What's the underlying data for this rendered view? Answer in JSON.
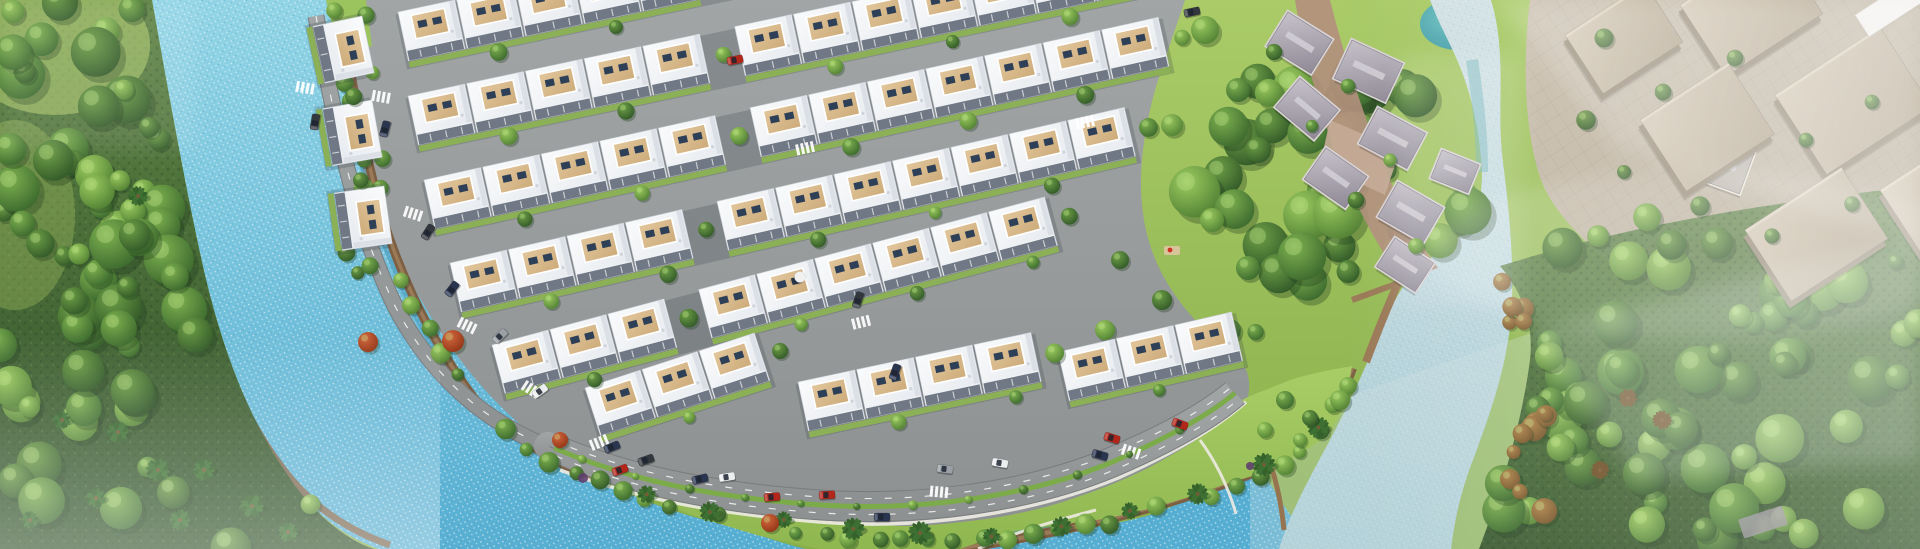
{
  "meta": {
    "title": "Aerial masterplan render — riverside townhouse estate",
    "type": "architectural-aerial-render",
    "width": 1920,
    "height": 549
  },
  "palette": {
    "lawn_hi": "#aacb68",
    "lawn_lo": "#88af4a",
    "lawn2_hi": "#a9cd66",
    "lawn2_lo": "#8fb750",
    "water_hi": "#93d5e6",
    "water_lo": "#56aed2",
    "water_deep": "#3a8cb0",
    "sparkle": "#eafafc",
    "pale_hi": "#d3e2e4",
    "pale_lo": "#a8ccd6",
    "pond_hi": "#6fc2c0",
    "pond_lo": "#3d96a4",
    "forest_hi": "#5d8243",
    "forest_lo": "#33532c",
    "road": "#949798",
    "road_dark": "#797c7e",
    "lane_white": "#ffffff",
    "trail": "#84603f",
    "trail_hi": "#9b7a58",
    "trail_dark": "#503b27",
    "house_hi": "#fafbfc",
    "house_lo": "#e4e8ed",
    "house_side": "#d7dce2",
    "facade": "#6f7884",
    "parapet": "#eef1f4",
    "roof_hi": "#e2c79c",
    "roof_lo": "#cdab7a",
    "window": "#2e4057",
    "median": "#7cab4a",
    "garden": "#8bb055",
    "path_white": "#edeae2",
    "tree_a_hi": "#9ccb60",
    "tree_a_lo": "#49782f",
    "tree_b_hi": "#7fb250",
    "tree_b_lo": "#34612a",
    "tree_c_hi": "#6fa047",
    "tree_c_lo": "#2b5125",
    "red_hi": "#d2683e",
    "red_lo": "#8c3012",
    "brown_hi": "#b08448",
    "brown_lo": "#6f4f26",
    "palm": "#35612b",
    "palm2": "#3d7032",
    "palm_trunk": "#7a5a36",
    "vroof_hi": "#c6c1c9",
    "vroof_lo": "#8f8a96",
    "vwall": "#d9d3d6",
    "vground": "#b28f7d",
    "vplaza": "#c5ab97",
    "beige_hi": "#d3c7b3",
    "beige_lo": "#b1a38c",
    "beige_side": "#978a76",
    "plaza_hi": "#cbc0af",
    "plaza_lo": "#b5aa96",
    "cream_wall": "#ece4d2",
    "cream_roof": "#b9b2a8",
    "car_red": "#b3261a",
    "car_navy": "#2a3550",
    "car_gray": "#9aa0a6",
    "car_white": "#eceef0",
    "car_dark": "#33383f",
    "shrub_purple": "#5e3f6e",
    "haze": "#ffffff"
  },
  "estate": {
    "unit": {
      "w": 60,
      "d": 50,
      "roof_w": 34,
      "roof_d": 24,
      "gap": 34
    },
    "rows": [
      {
        "x": 398,
        "y": 12,
        "a": -12,
        "segs": [
          5,
          7
        ]
      },
      {
        "x": 408,
        "y": 96,
        "a": -12,
        "segs": [
          5,
          7
        ]
      },
      {
        "x": 424,
        "y": 180,
        "a": -12.5,
        "segs": [
          5,
          7
        ]
      },
      {
        "x": 450,
        "y": 263,
        "a": -13,
        "segs": [
          4,
          7
        ]
      },
      {
        "x": 492,
        "y": 345,
        "a": -15,
        "segs": [
          3,
          6
        ]
      },
      {
        "x": 585,
        "y": 388,
        "a": -18,
        "segs": [
          3
        ]
      },
      {
        "x": 798,
        "y": 382,
        "a": -12,
        "segs": [
          4
        ]
      },
      {
        "x": 1058,
        "y": 352,
        "a": -13,
        "segs": [
          3
        ]
      },
      {
        "x": 362,
        "y": 16,
        "a": 78,
        "segs": [
          1
        ]
      },
      {
        "x": 372,
        "y": 100,
        "a": 80,
        "segs": [
          1
        ]
      },
      {
        "x": 384,
        "y": 186,
        "a": 82,
        "segs": [
          1
        ]
      }
    ]
  },
  "cars": [
    [
      612,
      447,
      -22,
      "navy"
    ],
    [
      646,
      460,
      -20,
      "dark"
    ],
    [
      700,
      479,
      -13,
      "navy"
    ],
    [
      727,
      477,
      -9,
      "white"
    ],
    [
      772,
      497,
      -5,
      "red"
    ],
    [
      827,
      495,
      -3,
      "red"
    ],
    [
      882,
      517,
      0,
      "navy"
    ],
    [
      945,
      469,
      7,
      "gray"
    ],
    [
      1000,
      463,
      10,
      "white"
    ],
    [
      1100,
      455,
      16,
      "navy"
    ],
    [
      1112,
      438,
      17,
      "red"
    ],
    [
      1180,
      424,
      21,
      "red"
    ],
    [
      620,
      470,
      -20,
      "red"
    ],
    [
      540,
      391,
      -36,
      "white"
    ],
    [
      500,
      336,
      -45,
      "gray"
    ],
    [
      452,
      289,
      -52,
      "navy"
    ],
    [
      428,
      232,
      -57,
      "dark"
    ],
    [
      385,
      129,
      -75,
      "navy"
    ],
    [
      315,
      122,
      -80,
      "dark"
    ],
    [
      735,
      60,
      -11,
      "red"
    ],
    [
      895,
      372,
      -70,
      "navy"
    ],
    [
      858,
      300,
      -72,
      "dark"
    ],
    [
      1192,
      12,
      -12,
      "dark"
    ]
  ],
  "crossings": [
    [
      306,
      88,
      10
    ],
    [
      382,
      97,
      10
    ],
    [
      414,
      214,
      18
    ],
    [
      468,
      326,
      26
    ],
    [
      532,
      390,
      33
    ],
    [
      600,
      442,
      -22
    ],
    [
      806,
      148,
      -12
    ],
    [
      862,
      322,
      -14
    ],
    [
      1086,
      122,
      -12
    ],
    [
      940,
      492,
      5
    ],
    [
      1132,
      452,
      18
    ]
  ],
  "flora": {
    "red_trees": [
      [
        368,
        342,
        10
      ],
      [
        453,
        341,
        11
      ],
      [
        770,
        523,
        9
      ],
      [
        560,
        440,
        8
      ]
    ],
    "purple_shrubs": [
      [
        583,
        478,
        5
      ],
      [
        1250,
        466,
        4
      ]
    ],
    "west_palms": [
      [
        138,
        196,
        10
      ],
      [
        62,
        420,
        9
      ],
      [
        118,
        432,
        11
      ],
      [
        158,
        470,
        12
      ],
      [
        96,
        498,
        10
      ],
      [
        204,
        470,
        11
      ],
      [
        252,
        506,
        12
      ],
      [
        30,
        520,
        9
      ],
      [
        180,
        520,
        11
      ],
      [
        288,
        532,
        10
      ]
    ],
    "wedge_trees": [
      [
        1285,
        400,
        9
      ],
      [
        1310,
        418,
        8
      ],
      [
        1340,
        400,
        10
      ],
      [
        1300,
        440,
        7
      ],
      [
        1265,
        430,
        8
      ]
    ],
    "lawn_trees": [
      [
        1205,
        30,
        14
      ],
      [
        1238,
        90,
        12
      ],
      [
        1172,
        125,
        11
      ],
      [
        1258,
        150,
        13
      ],
      [
        1156,
        55,
        9
      ],
      [
        1212,
        220,
        12
      ],
      [
        1248,
        268,
        12
      ],
      [
        1162,
        300,
        10
      ],
      [
        1120,
        260,
        9
      ],
      [
        1105,
        330,
        10
      ],
      [
        1230,
        330,
        11
      ]
    ],
    "plaza_trees": [
      [
        1604,
        38
      ],
      [
        1663,
        92
      ],
      [
        1735,
        58
      ],
      [
        1806,
        140
      ],
      [
        1872,
        102
      ],
      [
        1624,
        172
      ],
      [
        1700,
        206
      ],
      [
        1772,
        236
      ],
      [
        1852,
        204
      ],
      [
        1896,
        262
      ],
      [
        1586,
        120
      ]
    ],
    "village_trees": [
      [
        1274,
        52
      ],
      [
        1348,
        86
      ],
      [
        1312,
        126
      ],
      [
        1390,
        160
      ],
      [
        1356,
        200
      ],
      [
        1416,
        246
      ]
    ],
    "riverside_trees": 10,
    "autumn_palms": [
      [
        1628,
        398
      ],
      [
        1662,
        420
      ],
      [
        1600,
        470
      ]
    ]
  },
  "village": {
    "houses": [
      [
        1288,
        12,
        32,
        52,
        40
      ],
      [
        1352,
        40,
        25,
        56,
        42
      ],
      [
        1300,
        78,
        40,
        50,
        38
      ],
      [
        1378,
        108,
        28,
        54,
        40
      ],
      [
        1326,
        148,
        35,
        50,
        38
      ],
      [
        1398,
        182,
        30,
        52,
        40
      ],
      [
        1442,
        150,
        22,
        40,
        30
      ],
      [
        1395,
        238,
        33,
        46,
        34
      ]
    ],
    "cream_house": [
      1698,
      132,
      20,
      60,
      44
    ]
  },
  "plaza": {
    "buildings": [
      [
        1565,
        35,
        95,
        70
      ],
      [
        1680,
        5,
        115,
        85
      ],
      [
        1640,
        120,
        105,
        85
      ],
      [
        1775,
        95,
        125,
        95
      ],
      [
        1745,
        230,
        115,
        85
      ],
      [
        1880,
        190,
        95,
        75
      ]
    ],
    "white_bar": [
      1855,
      15,
      70,
      26
    ],
    "angle": -33
  },
  "park": {
    "cluster_center": [
      1325,
      180
    ],
    "cluster_rx": 150,
    "cluster_ry": 115
  },
  "counts": {
    "left_forest": 80,
    "right_forest": 70,
    "park_cluster": 36,
    "autumn_blobs": 14
  },
  "seed": 11
}
